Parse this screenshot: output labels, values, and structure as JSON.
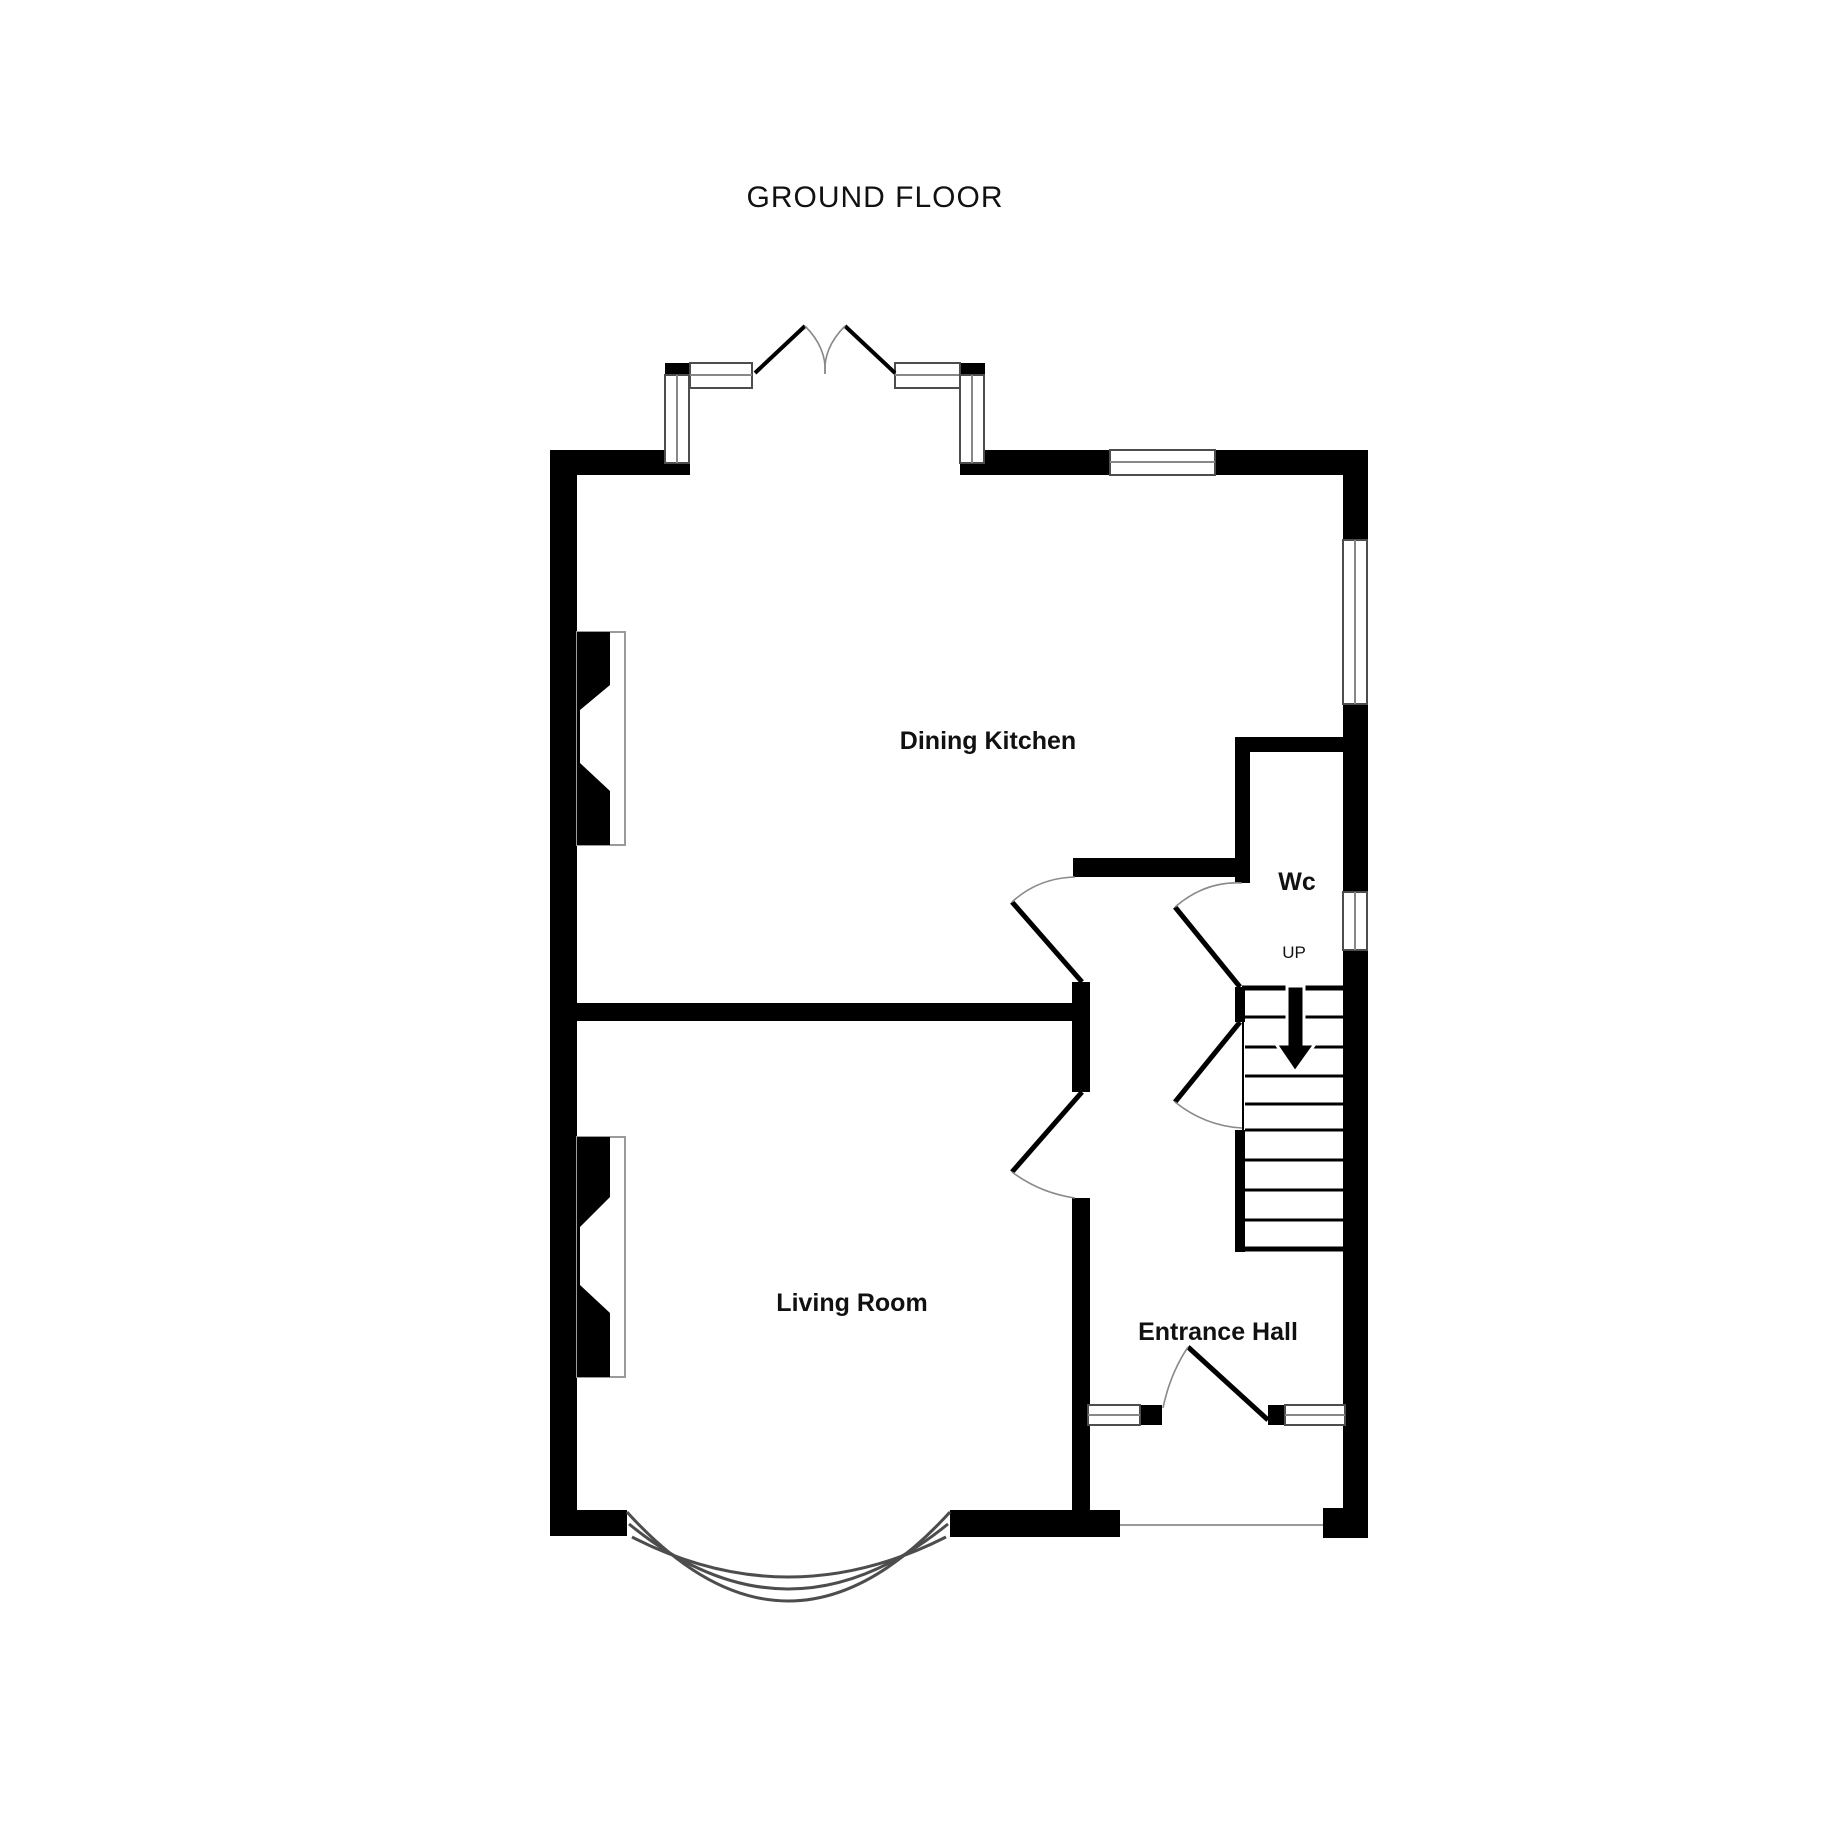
{
  "title": "GROUND FLOOR",
  "rooms": {
    "dining_kitchen": "Dining Kitchen",
    "wc": "Wc",
    "living_room": "Living Room",
    "entrance_hall": "Entrance Hall"
  },
  "stairs": {
    "direction_label": "UP"
  },
  "colors": {
    "wall": "#000000",
    "window_frame": "#4d4d4d",
    "window_pane": "#888888",
    "door_swing": "#8a8a8a",
    "thin_line": "#9a9a9a",
    "text": "#111111",
    "background": "#ffffff"
  }
}
